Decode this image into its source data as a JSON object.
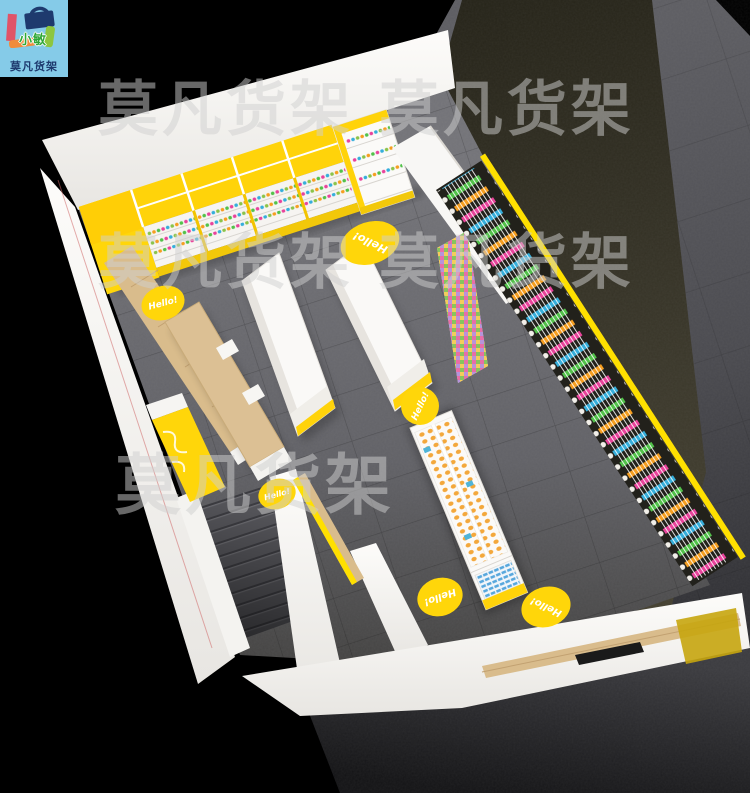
{
  "logo": {
    "badge_text": "小敏",
    "brand_text": "莫凡货架"
  },
  "watermarks": {
    "row1": "莫凡货架 莫凡货架",
    "row2": "莫凡货架 莫凡货架",
    "row3": "莫凡货架"
  },
  "floor_badge": {
    "label": "Hello!"
  },
  "palette": {
    "accent_yellow": "#FFD60A",
    "stripe_yellow": "#FFE000",
    "wood": "#D9BC8C",
    "floor_gray": "#67676B",
    "walkway_gray": "#4B4B4E",
    "dark_olive": "#3A372A",
    "logo_bg": "#85CBE8",
    "logo_navy": "#1E3A6E",
    "logo_pink": "#E05468",
    "logo_orange": "#F08C3C",
    "logo_green": "#8DC63F",
    "product_colors": [
      "#F59E20",
      "#E8439B",
      "#35AEDB",
      "#52C14A",
      "#C83CC8"
    ]
  }
}
